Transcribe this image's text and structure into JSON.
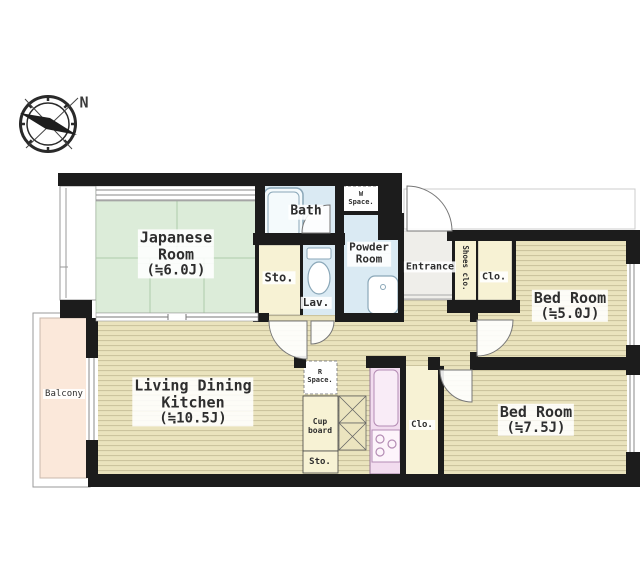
{
  "compass": {
    "north_label": "N"
  },
  "rooms": {
    "japanese": {
      "line1": "Japanese",
      "line2": "Room",
      "size": "(≒6.0J)"
    },
    "bath": {
      "name": "Bath"
    },
    "washer_space": {
      "line1": "W",
      "line2": "Space."
    },
    "powder": {
      "line1": "Powder",
      "line2": "Room"
    },
    "storage_wash": {
      "name": "Sto."
    },
    "lavatory": {
      "name": "Lav."
    },
    "entrance": {
      "name": "Entrance"
    },
    "shoes_closet": {
      "name": "Shoes clo."
    },
    "closet_top": {
      "name": "Clo."
    },
    "bedroom_5": {
      "name": "Bed Room",
      "size": "(≒5.0J)"
    },
    "bedroom_75": {
      "name": "Bed Room",
      "size": "(≒7.5J)"
    },
    "ldk": {
      "line1": "Living Dining",
      "line2": "Kitchen",
      "size": "(≒10.5J)"
    },
    "balcony": {
      "name": "Balcony"
    },
    "fridge_space": {
      "line1": "R",
      "line2": "Space."
    },
    "cupboard": {
      "line1": "Cup",
      "line2": "board"
    },
    "storage_kitchen": {
      "name": "Sto."
    },
    "closet_bottom": {
      "name": "Clo."
    }
  },
  "colors": {
    "wall": "#1c1c1c",
    "tatami": "#dcecd9",
    "wood": "#eae3bd",
    "wood_stripe": "#c9c09a",
    "water": "#daeaf3",
    "closet": "#f7f2d4",
    "balcony": "#fbe8da",
    "entrance_floor": "#efeeea",
    "kitchen_counter": "#f2dcef",
    "background": "#ffffff"
  }
}
